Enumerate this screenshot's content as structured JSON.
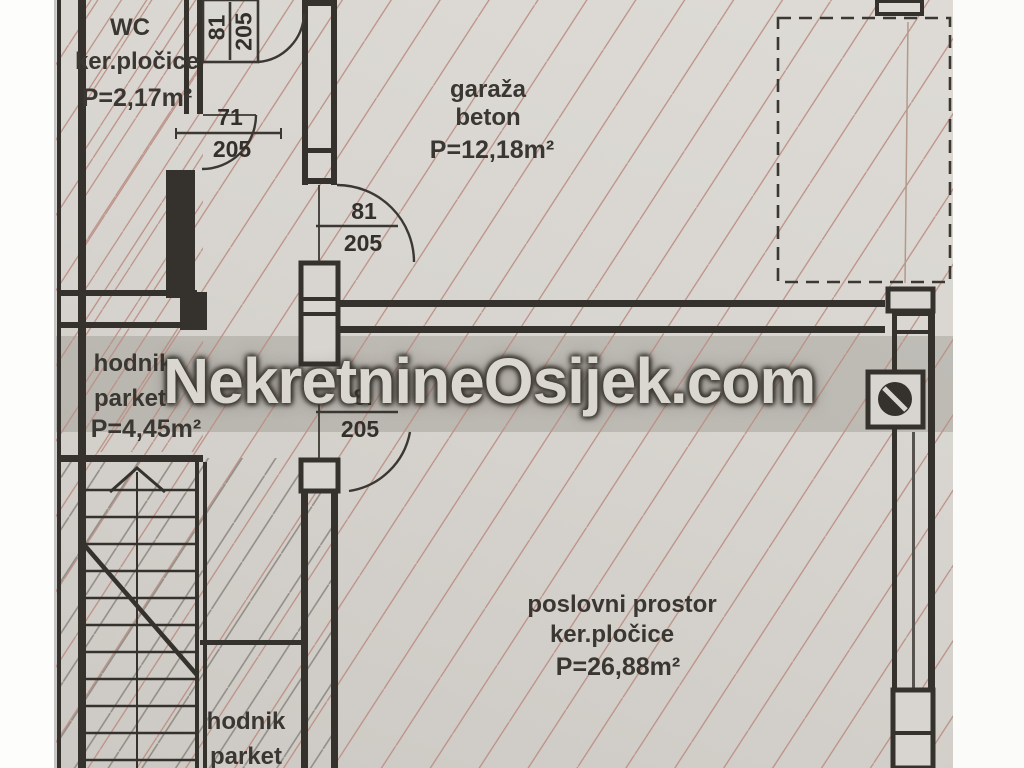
{
  "watermark": {
    "text": "NekretnineOsijek.com"
  },
  "rooms": {
    "wc": {
      "name": "WC",
      "floor": "ker.pločice",
      "area": "P=2,17m²"
    },
    "garaza": {
      "name": "garaža",
      "floor": "beton",
      "area": "P=12,18m²"
    },
    "hodnik": {
      "name": "hodnik",
      "floor": "parket",
      "area": "P=4,45m²"
    },
    "poslovni": {
      "name": "poslovni prostor",
      "floor": "ker.pločice",
      "area": "P=26,88m²"
    },
    "hodnik_donji": {
      "name": "hodnik",
      "floor": "parket"
    }
  },
  "doors": {
    "ulaz_gore": {
      "sirina": "81",
      "visina": "205"
    },
    "wc_vrata": {
      "sirina": "71",
      "visina": "205"
    },
    "garaza_vrata": {
      "sirina": "81",
      "visina": "205"
    },
    "poslovni_vrata": {
      "sirina": "8.",
      "visina": "205"
    }
  },
  "colors": {
    "paper": "#d8d5d0",
    "wall": "#35322e",
    "hatch_red": "#bb8f84",
    "hatch_gray": "#918c85",
    "watermark_fill": "#dad7d1",
    "watermark_shadow": "#3c3832"
  }
}
